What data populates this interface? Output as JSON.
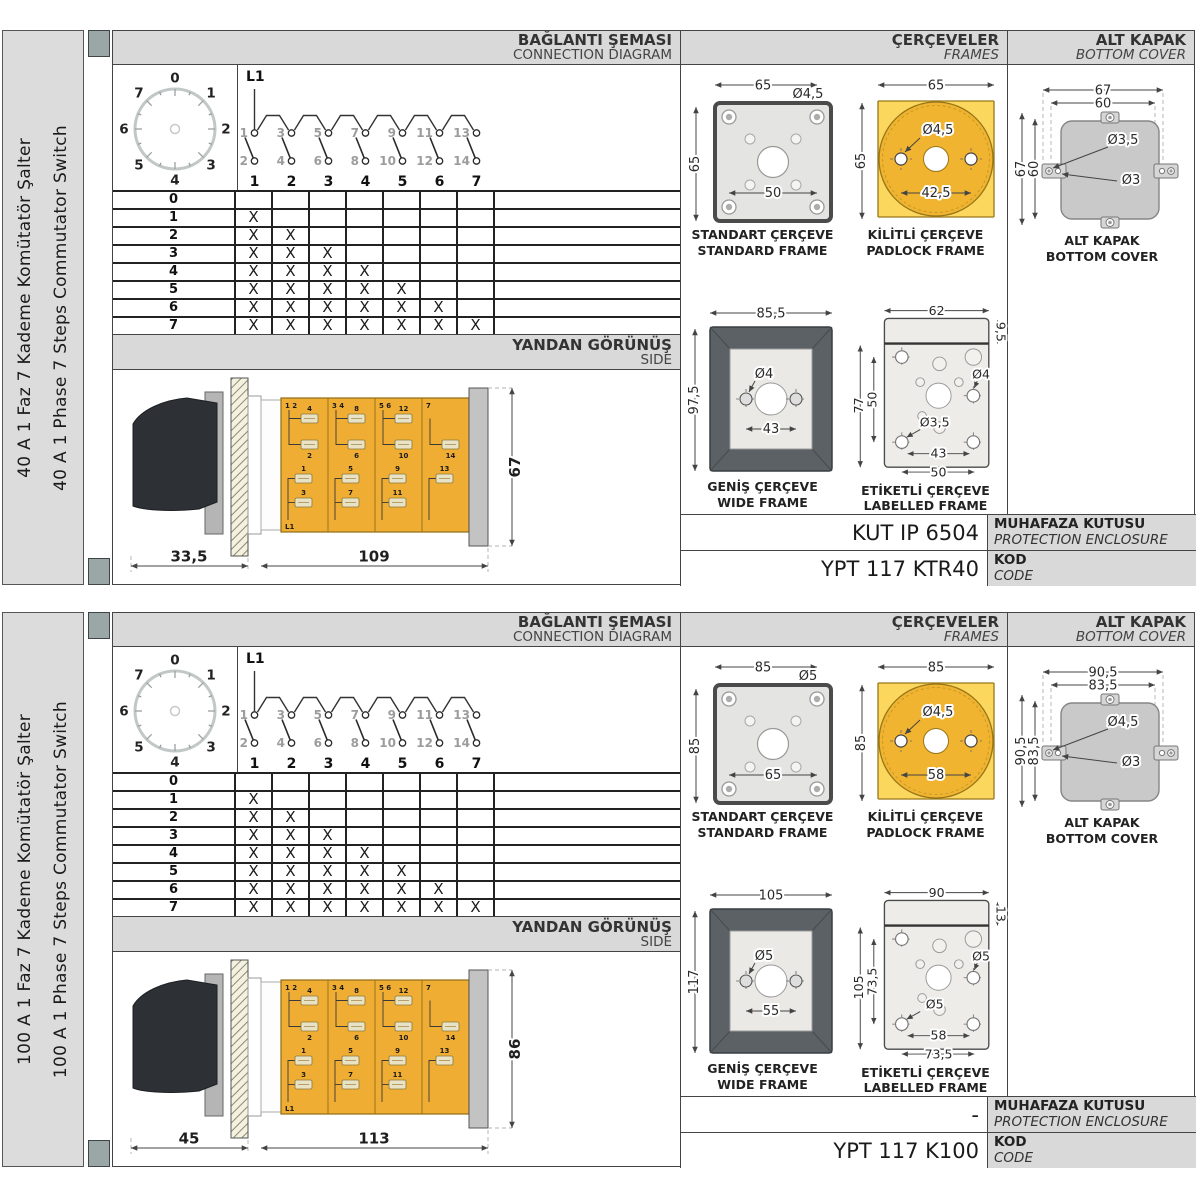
{
  "headers": {
    "connection": {
      "tr": "BAĞLANTI ŞEMASI",
      "en": "CONNECTION DIAGRAM"
    },
    "frames": {
      "tr": "ÇERÇEVELER",
      "en": "FRAMES"
    },
    "cover": {
      "tr": "ALT KAPAK",
      "en": "BOTTOM COVER"
    },
    "side": {
      "tr": "YANDAN GÖRÜNÜŞ",
      "en": "SIDE"
    }
  },
  "labels": {
    "l1": "L1",
    "enclosure": {
      "tr": "MUHAFAZA KUTUSU",
      "en": "PROTECTION ENCLOSURE"
    },
    "code": {
      "tr": "KOD",
      "en": "CODE"
    }
  },
  "captions": {
    "standard": {
      "tr": "STANDART ÇERÇEVE",
      "en": "STANDARD FRAME"
    },
    "padlock": {
      "tr": "KİLİTLİ ÇERÇEVE",
      "en": "PADLOCK FRAME"
    },
    "wide": {
      "tr": "GENİŞ ÇERÇEVE",
      "en": "WIDE FRAME"
    },
    "labelled": {
      "tr": "ETİKETLİ ÇERÇEVE",
      "en": "LABELLED FRAME"
    },
    "cover": {
      "tr": "ALT KAPAK",
      "en": "BOTTOM COVER"
    }
  },
  "dial": {
    "positions": [
      "0",
      "1",
      "2",
      "3",
      "4",
      "5",
      "6",
      "7"
    ]
  },
  "circuit": {
    "source": "L1",
    "switches": [
      {
        "top": "1",
        "bottom": "2",
        "label": "1"
      },
      {
        "top": "3",
        "bottom": "4",
        "label": "2"
      },
      {
        "top": "5",
        "bottom": "6",
        "label": "3"
      },
      {
        "top": "7",
        "bottom": "8",
        "label": "4"
      },
      {
        "top": "9",
        "bottom": "10",
        "label": "5"
      },
      {
        "top": "11",
        "bottom": "12",
        "label": "6"
      },
      {
        "top": "13",
        "bottom": "14",
        "label": "7"
      }
    ]
  },
  "step_table": {
    "mark": "X",
    "rows": [
      {
        "step": "0",
        "closed": 0
      },
      {
        "step": "1",
        "closed": 1
      },
      {
        "step": "2",
        "closed": 2
      },
      {
        "step": "3",
        "closed": 3
      },
      {
        "step": "4",
        "closed": 4
      },
      {
        "step": "5",
        "closed": 5
      },
      {
        "step": "6",
        "closed": 6
      },
      {
        "step": "7",
        "closed": 7
      }
    ]
  },
  "side_view": {
    "sections": [
      {
        "corner": "1 2",
        "t1": "4",
        "t2": "2",
        "b1": "1",
        "b2": "3"
      },
      {
        "corner": "3 4",
        "t1": "8",
        "t2": "6",
        "b1": "5",
        "b2": "7"
      },
      {
        "corner": "5 6",
        "t1": "12",
        "t2": "10",
        "b1": "9",
        "b2": "11"
      },
      {
        "corner": "7",
        "t2": "14",
        "b1": "13"
      }
    ]
  },
  "colors": {
    "padlock_square_yellow": "#FCD75E",
    "padlock_circle_yellow": "#F1B430",
    "switch_body_yellow": "#F0AD33",
    "header_gray": "#D9D9D9",
    "tab_gray": "#9BA7A7",
    "wide_frame_dark": "#5B6165"
  },
  "panels": [
    {
      "sidebar": {
        "tr": "40 A 1 Faz 7 Kademe Komütatör Şalter",
        "en": "40 A 1 Phase 7 Steps Commutator Switch"
      },
      "side_dims": {
        "front": "33,5",
        "body": "109",
        "height": "67"
      },
      "frames": {
        "standard": {
          "width": "65",
          "height": "65",
          "hole": "Ø4,5",
          "bolt_span": "50"
        },
        "padlock": {
          "width": "65",
          "height": "65",
          "hole": "Ø4,5",
          "hole_span": "42,5"
        },
        "wide": {
          "width": "85,5",
          "height": "97,5",
          "hole": "Ø4",
          "hole_span": "43"
        },
        "labelled": {
          "width": "62",
          "band_height": "9,5",
          "height": "77",
          "hole_span_v": "50",
          "hole_right": "Ø4",
          "hole_bottom_left": "Ø3,5",
          "hole_span_h": "43",
          "bolt_span_h": "50"
        }
      },
      "cover_dims": {
        "outer_width": "67",
        "inner_width": "60",
        "outer_height": "67",
        "inner_height": "60",
        "tab_hole": "Ø3,5",
        "small_hole": "Ø3"
      },
      "codes": {
        "enclosure": "KUT IP 6504",
        "code": "YPT 117 KTR40"
      }
    },
    {
      "sidebar": {
        "tr": "100 A 1 Faz 7 Kademe Komütatör Şalter",
        "en": "100 A 1 Phase 7 Steps Commutator Switch"
      },
      "side_dims": {
        "front": "45",
        "body": "113",
        "height": "86"
      },
      "frames": {
        "standard": {
          "width": "85",
          "height": "85",
          "hole": "Ø5",
          "bolt_span": "65"
        },
        "padlock": {
          "width": "85",
          "height": "85",
          "hole": "Ø4,5",
          "hole_span": "58"
        },
        "wide": {
          "width": "105",
          "height": "117",
          "hole": "Ø5",
          "hole_span": "55"
        },
        "labelled": {
          "width": "90",
          "band_height": "13",
          "height": "105",
          "hole_span_v": "73,5",
          "hole_right": "Ø5",
          "hole_bottom_left": "Ø5",
          "hole_span_h": "58",
          "bolt_span_h": "73,5"
        }
      },
      "cover_dims": {
        "outer_width": "90,5",
        "inner_width": "83,5",
        "outer_height": "90,5",
        "inner_height": "83,5",
        "tab_hole": "Ø4,5",
        "small_hole": "Ø3"
      },
      "codes": {
        "enclosure": "-",
        "code": "YPT 117 K100"
      }
    }
  ]
}
